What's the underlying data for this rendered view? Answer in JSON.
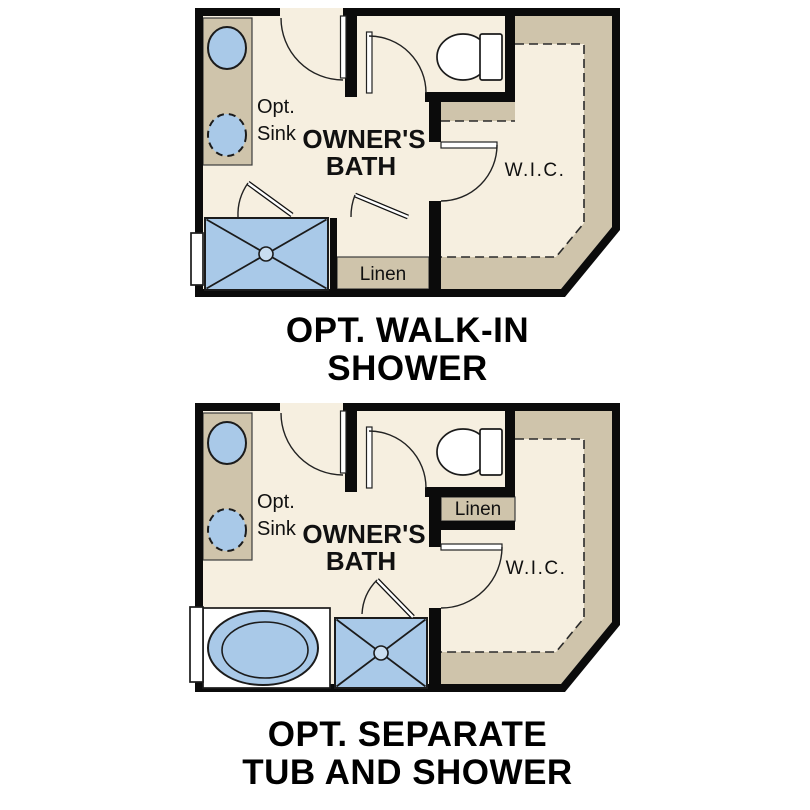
{
  "colors": {
    "wall": "#0b0b0b",
    "floor": "#f6efe0",
    "cabinet_tan": "#cfc4ab",
    "fixture_blue": "#a9c9e8",
    "outline": "#1b1b1b",
    "text": "#111111",
    "background": "#ffffff"
  },
  "plans": [
    {
      "id": "opt-walk-in-shower",
      "title_line1": "OPT. WALK-IN",
      "title_line2": "SHOWER",
      "labels": {
        "opt_line1": "Opt.",
        "opt_line2": "Sink",
        "bath_line1": "OWNER'S",
        "bath_line2": "BATH",
        "wic": "W.I.C.",
        "linen": "Linen"
      }
    },
    {
      "id": "opt-separate-tub-and-shower",
      "title_line1": "OPT. SEPARATE",
      "title_line2": "TUB AND SHOWER",
      "labels": {
        "opt_line1": "Opt.",
        "opt_line2": "Sink",
        "bath_line1": "OWNER'S",
        "bath_line2": "BATH",
        "wic": "W.I.C.",
        "linen": "Linen"
      }
    }
  ]
}
